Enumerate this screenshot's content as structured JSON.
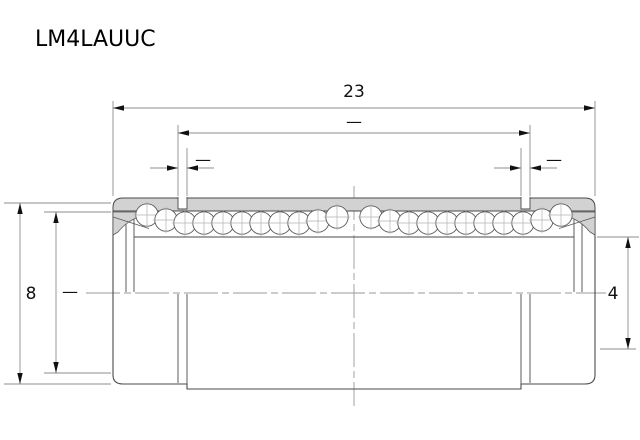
{
  "title": "LM4LAUUC",
  "colors": {
    "background": "#ffffff",
    "outline": "#4a4a4a",
    "fill_gray": "#d2d2d2",
    "dim_line": "#8c8c8c",
    "center_line": "#9a9a9a",
    "annotation": "#111111"
  },
  "dimensions": {
    "overall_length": {
      "value": "23"
    },
    "groove_span": {
      "value": "—"
    },
    "left_groove_width": {
      "value": "—"
    },
    "right_groove_width": {
      "value": "—"
    },
    "outer_diameter": {
      "value": "8"
    },
    "seal_recess_diameter": {
      "value": "—"
    },
    "bore_diameter": {
      "value": "4"
    }
  },
  "drawing": {
    "ball_radius": 11.2,
    "ball_row_y": 223,
    "ball_groups": [
      {
        "name": "left",
        "start_x": 147,
        "count": 11,
        "spacing": 19,
        "dy": [
          -8,
          -3,
          0,
          0,
          0,
          0,
          0,
          0,
          0,
          -2,
          -6
        ]
      },
      {
        "name": "right",
        "start_x": 371,
        "count": 11,
        "spacing": 19,
        "dy": [
          -6,
          -2,
          0,
          0,
          0,
          0,
          0,
          0,
          0,
          -3,
          -8
        ]
      }
    ]
  }
}
